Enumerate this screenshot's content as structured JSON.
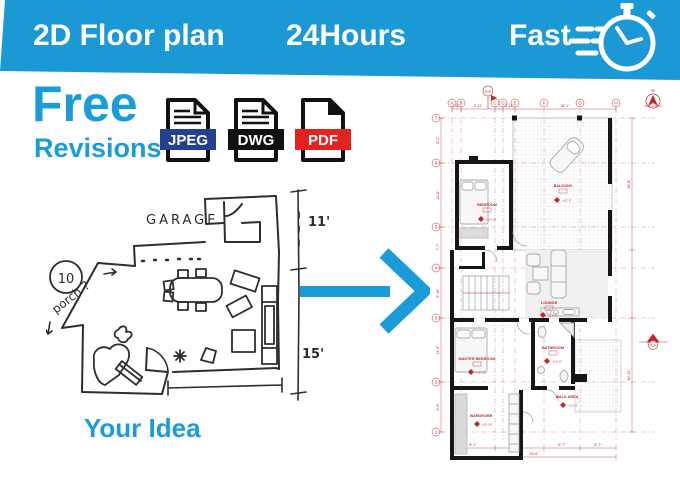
{
  "colors": {
    "banner_blue": "#1b99d5",
    "accent_blue": "#1b9cd8",
    "jpeg_badge": "#24418f",
    "dwg_badge": "#111111",
    "pdf_badge": "#e42320",
    "cad_red": "#c2262c",
    "wall_black": "#161616",
    "furniture_gray": "#a8a8a8"
  },
  "banner": {
    "title": "2D Floor plan",
    "turnaround": "24Hours",
    "speed_label": "Fast"
  },
  "offer": {
    "headline": "Free",
    "subline": "Revisions"
  },
  "formats": [
    {
      "label": "JPEG"
    },
    {
      "label": "DWG"
    },
    {
      "label": "PDF"
    }
  ],
  "sketch": {
    "caption": "Your Idea",
    "garage_label": "GARAGE",
    "porch_label": "porch ?",
    "circle_number": "10",
    "dim_right_top": "11'",
    "dim_right_bottom": "15'"
  },
  "cad": {
    "north_label": "N",
    "section_top": "B.B",
    "section_right": "A.A",
    "grid_columns": [
      "A",
      "B",
      "C",
      "D",
      "E",
      "F",
      "G",
      "H"
    ],
    "grid_rows": [
      "7",
      "6",
      "5",
      "4",
      "3",
      "2",
      "1"
    ],
    "rooms": [
      {
        "name": "BEDROOM",
        "level": "+12'-10\""
      },
      {
        "name": "BALCONY",
        "level": "+12'-0\""
      },
      {
        "name": "LOUNGE",
        "level": "+12'-0\""
      },
      {
        "name": "BATHROOM",
        "level": "+12'-0\""
      },
      {
        "name": "MASTER BEDROOM",
        "level": "+12'-10\""
      },
      {
        "name": "WALK AREA",
        "level": "+12'-0\""
      },
      {
        "name": "WARDROBE",
        "level": "+12'-10\""
      }
    ],
    "dims_top": [
      "2'-8\"",
      "5'-11\"",
      "3'-11\"",
      "18'-1\""
    ],
    "dims_bottom": [
      "8'-1\"",
      "7'-4\"",
      "8'-7\"",
      "8'-7\""
    ],
    "dim_total_bottom": "29'-8\"",
    "dims_left": [
      "8'-2\"",
      "11'-8\"",
      "7'-7\"",
      "8'-10\"",
      "11'-6\"",
      "9'-6\""
    ],
    "dims_right": [
      "18'-8\"",
      "16'-11\""
    ]
  }
}
